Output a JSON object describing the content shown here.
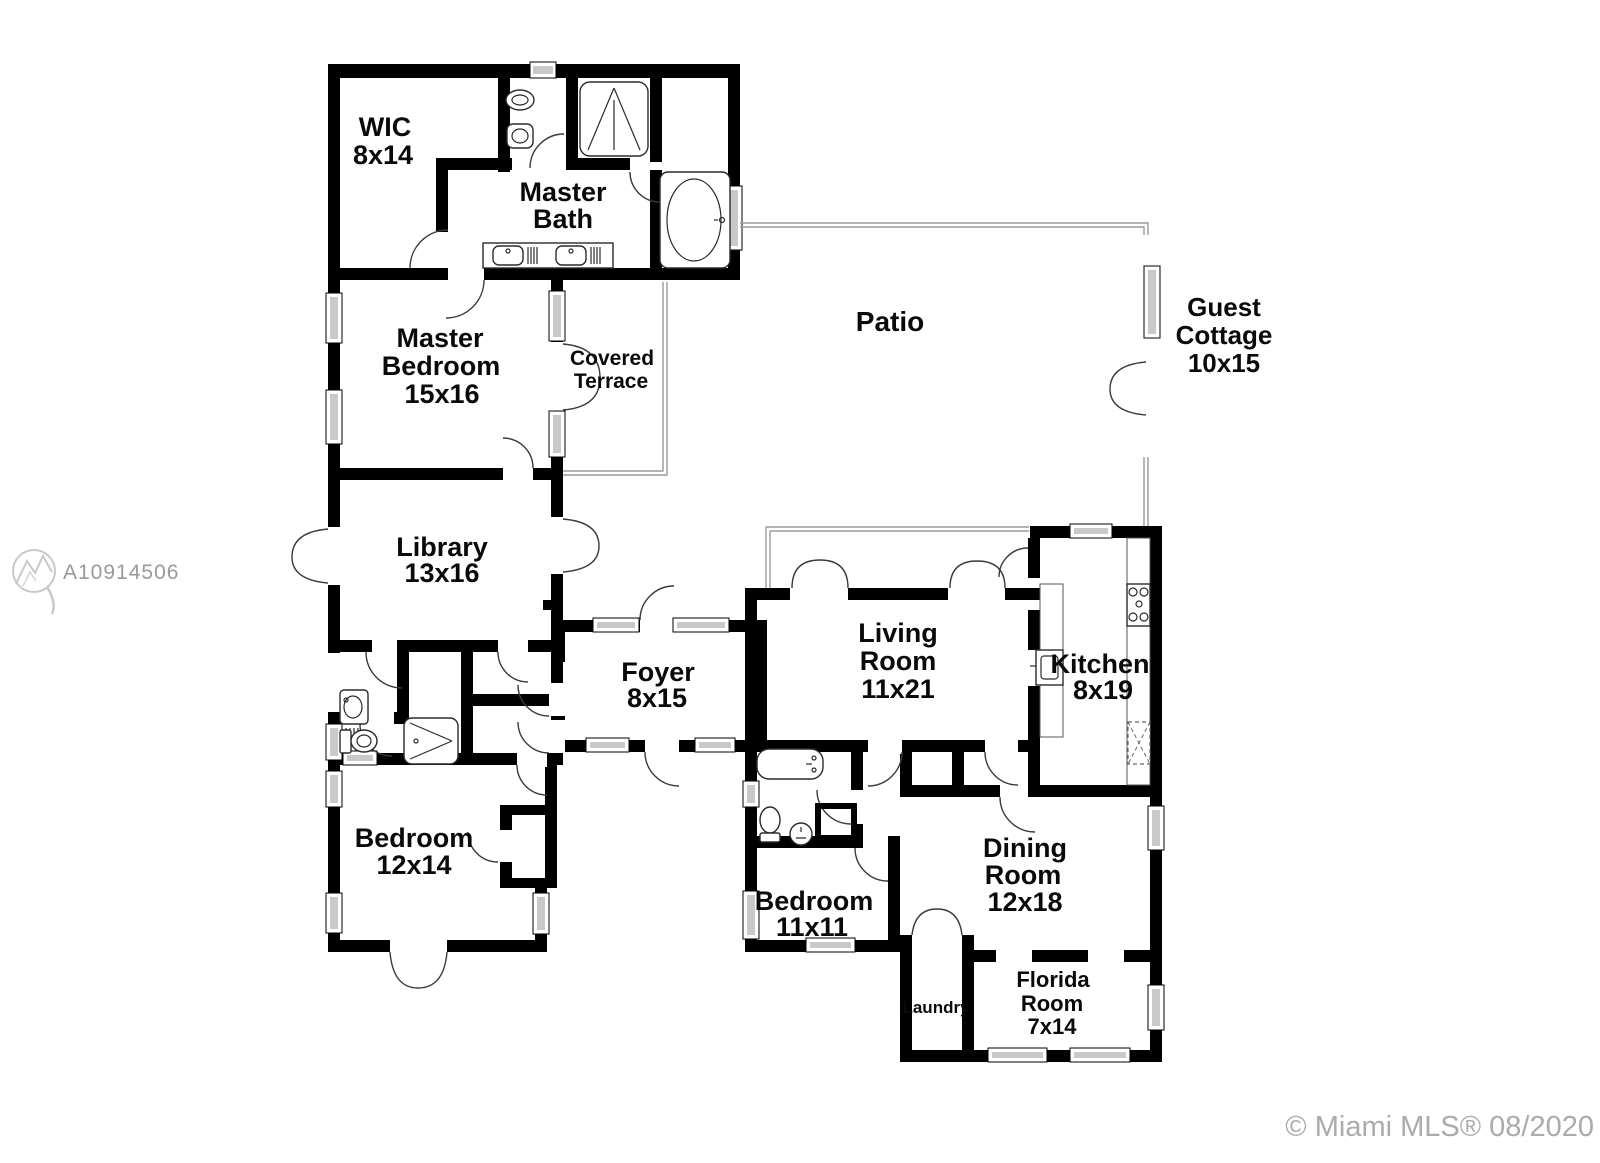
{
  "plan": {
    "rooms": {
      "wic": {
        "lines": [
          "WIC",
          "8x14"
        ]
      },
      "master_bath": {
        "lines": [
          "Master",
          "Bath"
        ]
      },
      "master_bedroom": {
        "lines": [
          "Master",
          "Bedroom",
          "15x16"
        ]
      },
      "covered_terrace": {
        "lines": [
          "Covered",
          "Terrace"
        ]
      },
      "patio": {
        "lines": [
          "Patio"
        ]
      },
      "guest_cottage": {
        "lines": [
          "Guest",
          "Cottage",
          "10x15"
        ]
      },
      "library": {
        "lines": [
          "Library",
          "13x16"
        ]
      },
      "foyer": {
        "lines": [
          "Foyer",
          "8x15"
        ]
      },
      "living_room": {
        "lines": [
          "Living",
          "Room",
          "11x21"
        ]
      },
      "kitchen": {
        "lines": [
          "Kitchen",
          "8x19"
        ]
      },
      "bedroom_12x14": {
        "lines": [
          "Bedroom",
          "12x14"
        ]
      },
      "bedroom_11x11": {
        "lines": [
          "Bedroom",
          "11x11"
        ]
      },
      "dining_room": {
        "lines": [
          "Dining",
          "Room",
          "12x18"
        ]
      },
      "laundry": {
        "lines": [
          "Laundry"
        ]
      },
      "florida_room": {
        "lines": [
          "Florida",
          "Room",
          "7x14"
        ]
      }
    },
    "watermark": {
      "listing_id": "A10914506"
    },
    "footer": {
      "copyright": "© Miami MLS® 08/2020"
    },
    "colors": {
      "wall": "#000000",
      "window_fill": "#c9c9c9",
      "thin_line": "#9a9a9a",
      "watermark_gray": "#97999c",
      "footer_gray": "#ababab"
    }
  }
}
